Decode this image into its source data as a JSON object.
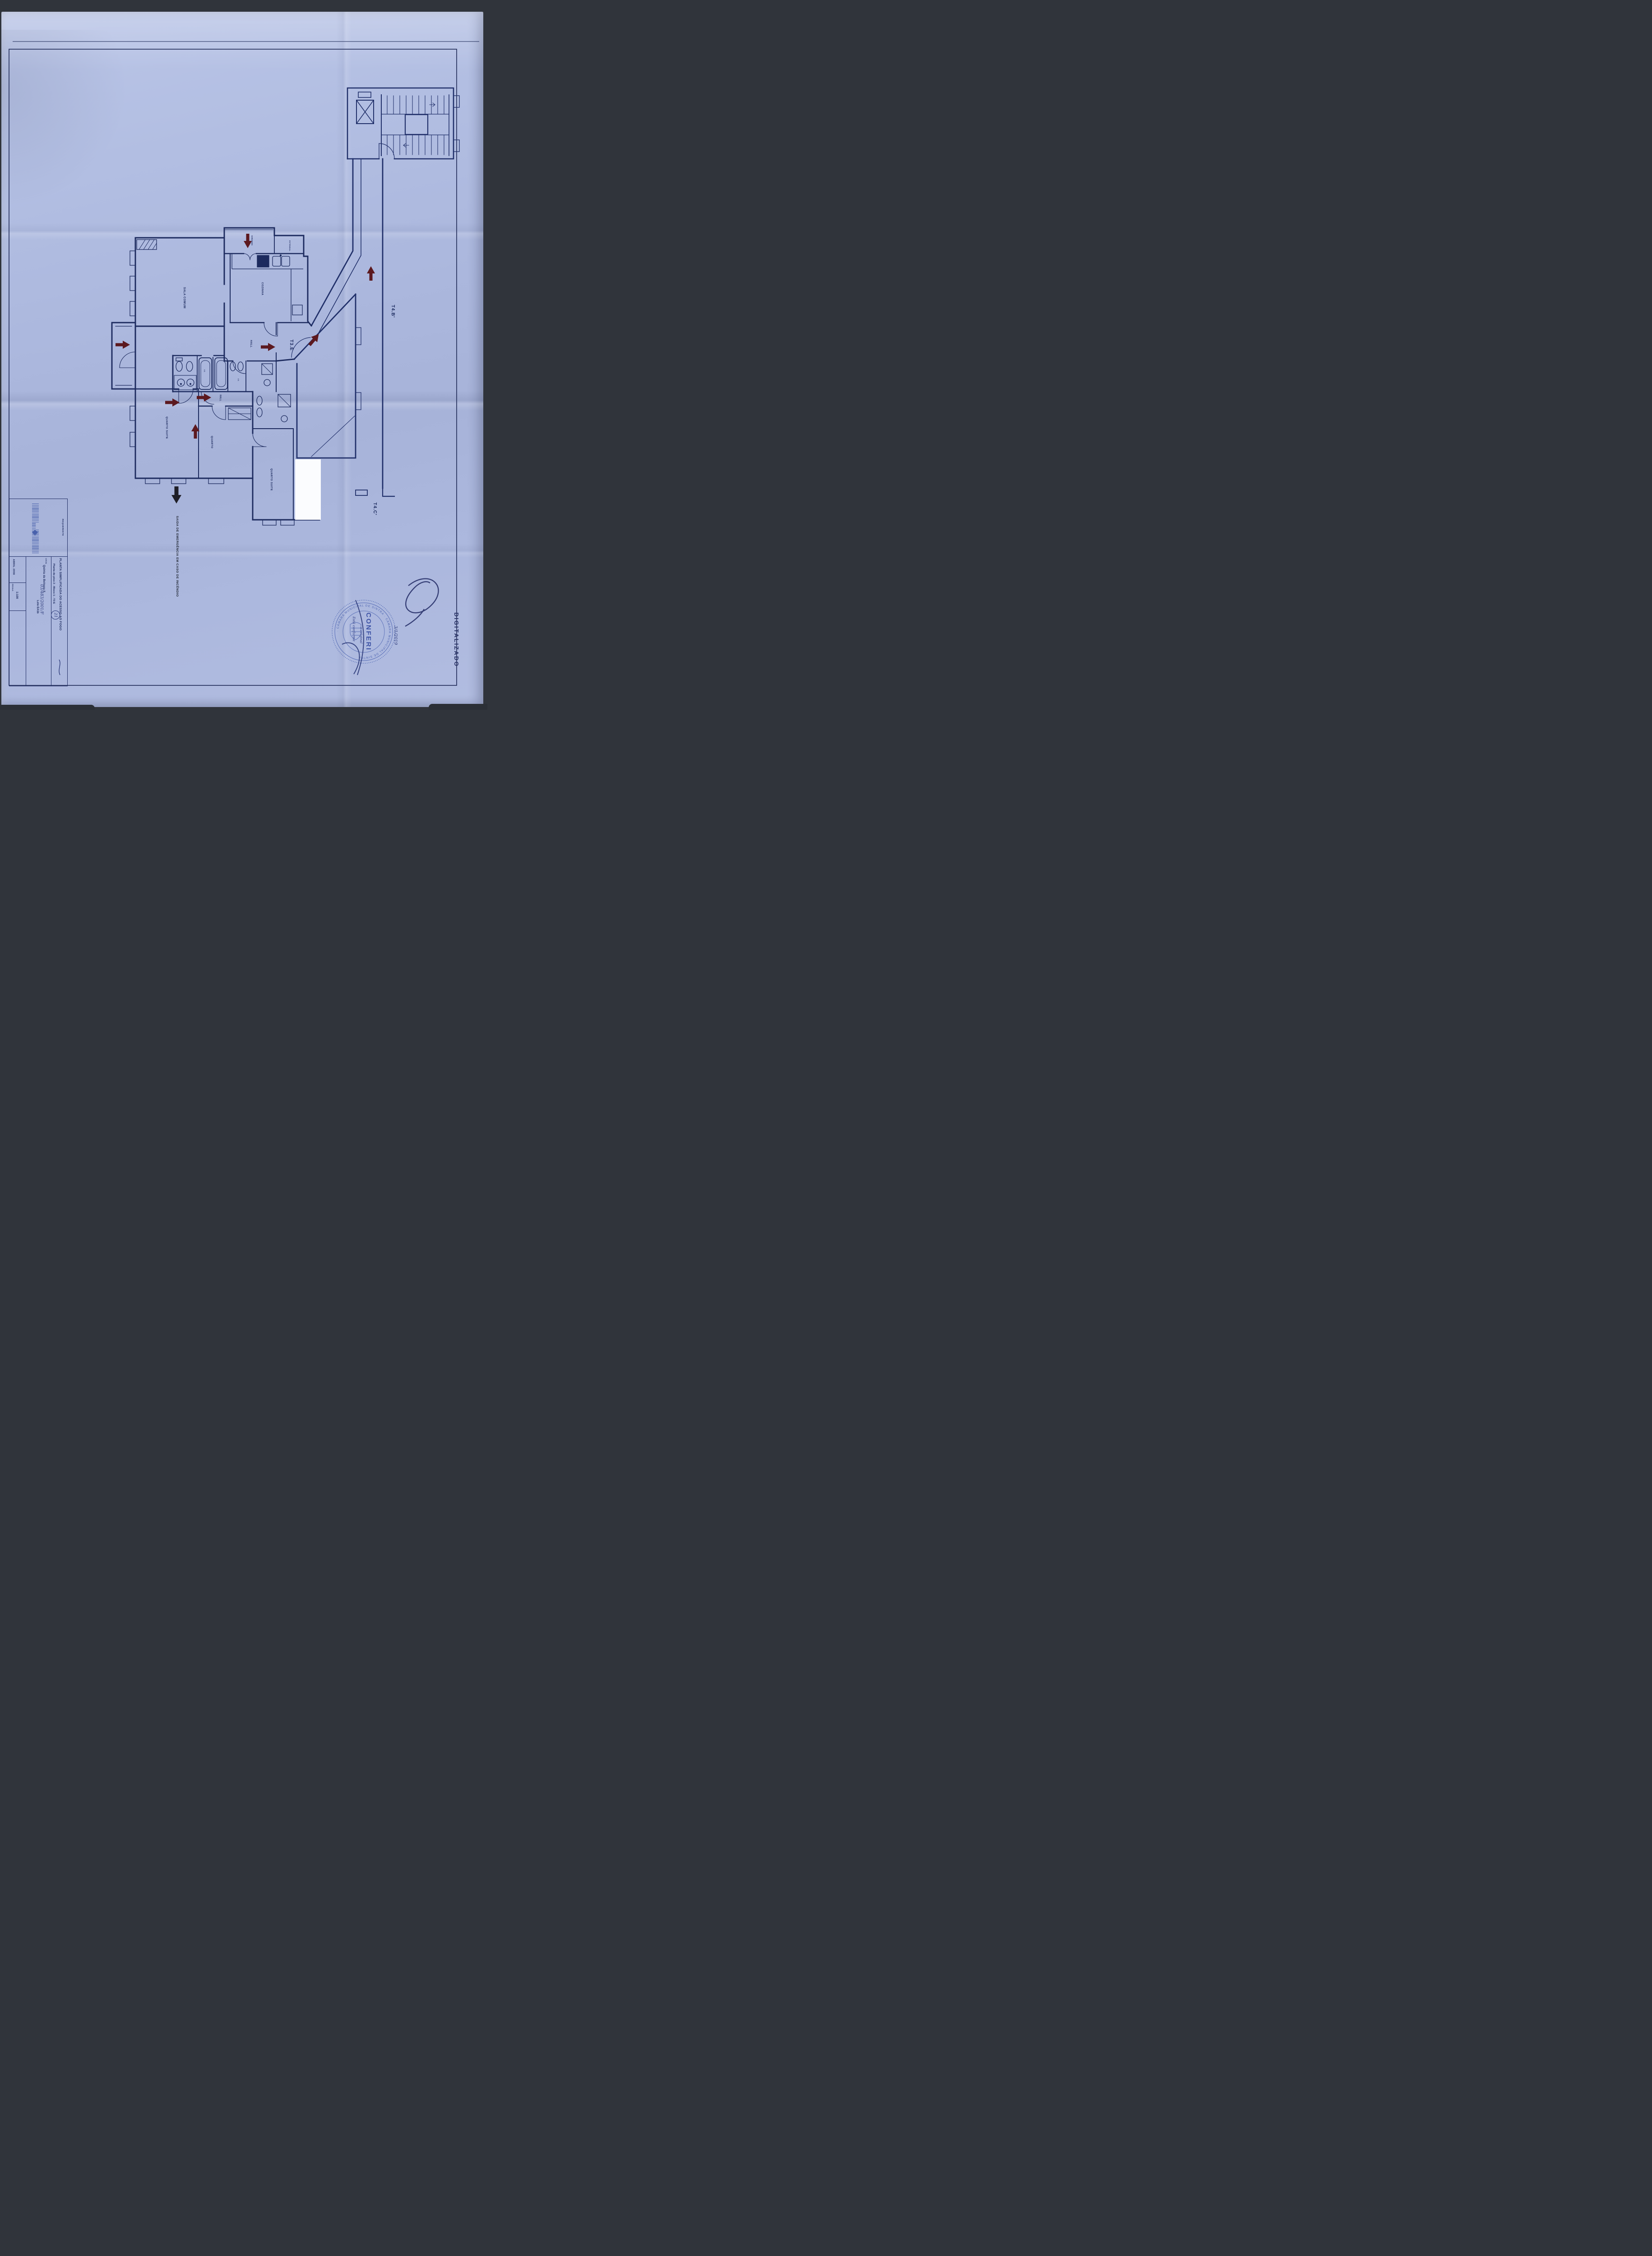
{
  "document": {
    "kind": "Scanned fire-access floor plan (blueprint)",
    "watermark": "DIGITALIZADO"
  },
  "title_block": {
    "requerente_label": "REQUERENTE",
    "title": "PLANTA SIMPLIFICADA DO ACESSO AO FOGO",
    "subtitle": "Planta do piso 2 - Bloco 1 - T3 E",
    "local_label": "LOCAL",
    "local_value": "Quinta da Beloura II",
    "local_value2": "Lote EA1b",
    "date": "ABRIL 2008",
    "scale_label": "ESCALA",
    "scale_value": "1:100"
  },
  "plan": {
    "unit_label": "T3.E",
    "corridor_label_up": "T4.B'",
    "corridor_label_down": "T4.C'",
    "emergency_note": "SAIDA DE EMERGÊNCIA EM CASO DE INCÊNDIO",
    "rooms": {
      "sala": "SALA COMUM",
      "cozinha": "COZINHA",
      "varanda": "VARANDA",
      "estendal": "ESTENDAL",
      "hall1": "HALL",
      "hall2": "HALL",
      "quarto_suite1": "QUARTO SUITE",
      "quarto": "QUARTO",
      "quarto_suite2": "QUARTO SUITE",
      "is1": "I.S.",
      "is2": "I.S."
    }
  },
  "stamp": {
    "ring_text": "· CÂMARA MUNICIPAL DE SINTRA · CÂMARA MUNICIPAL DE SINTRA",
    "stamp_word": "CONFERI",
    "note_line1": "Está conforme",
    "note_line2": "o original",
    "date": "3/1/2019"
  },
  "handwriting": {
    "process_ref": "03/483/2001/F",
    "circled_number": "21"
  },
  "colors": {
    "paper": "#adb9df",
    "ink": "#1d2b5f",
    "stamp_blue": "#4059ab",
    "arrow_red": "#5c191f",
    "scanner_bg": "#30343b"
  }
}
